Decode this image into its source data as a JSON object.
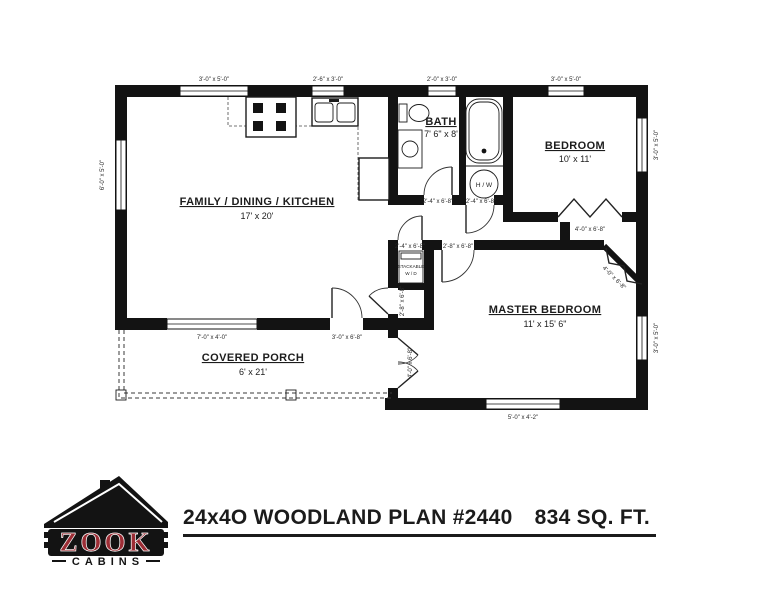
{
  "page": {
    "bg": "#ffffff",
    "ink": "#131313"
  },
  "plan": {
    "rooms": {
      "family": {
        "name": "FAMILY / DINING / KITCHEN",
        "dims": "17' x 20'"
      },
      "bath": {
        "name": "BATH",
        "dims": "7' 6\" x 8'"
      },
      "bedroom": {
        "name": "BEDROOM",
        "dims": "10' x 11'"
      },
      "master": {
        "name": "MASTER BEDROOM",
        "dims": "11' x 15' 6\""
      },
      "porch": {
        "name": "COVERED PORCH",
        "dims": "6' x 21'"
      }
    },
    "fixtures": {
      "water_heater": "H / W",
      "washer_dryer_line1": "STACKABLE",
      "washer_dryer_line2": "W / D"
    },
    "windows": {
      "top_family": "3'-0\" x 5'-0\"",
      "top_kitchen": "2'-6\" x 3'-0\"",
      "top_bath": "2'-0\" x 3'-0\"",
      "top_bedroom": "3'-0\" x 5'-0\"",
      "left_family": "6'-0\" x 5'-0\"",
      "right_bedroom": "3'-0\" x 5'-0\"",
      "right_master": "3'-0\" x 5'-0\"",
      "bottom_master": "5'-0\" x 4'-2\"",
      "porch_family": "7'-0\" x 4'-0\""
    },
    "doors": {
      "porch_entry": "3'-0\" x 6'-8\"",
      "bath": "2'-4\" x 6'-8\"",
      "water_heater": "2'-4\" x 6'-8\"",
      "laundry": "2'-4\" x 6'-8\"",
      "master_entry": "2'-8\" x 6'-8\"",
      "family_closet": "2'-8\" x 6'-8\"",
      "master_patio": "4'-0\" x 6'-8\"",
      "bedroom_closet": "4'-0\" x 6'-8\"",
      "master_closet": "4'-0\" x 6'-8\""
    }
  },
  "footer": {
    "logo": {
      "brand": "ZOOK",
      "sub": "CABINS",
      "red": "#9c2d35"
    },
    "title_plan": "24x4O WOODLAND PLAN #2440",
    "title_sqft": "834 SQ. FT."
  }
}
